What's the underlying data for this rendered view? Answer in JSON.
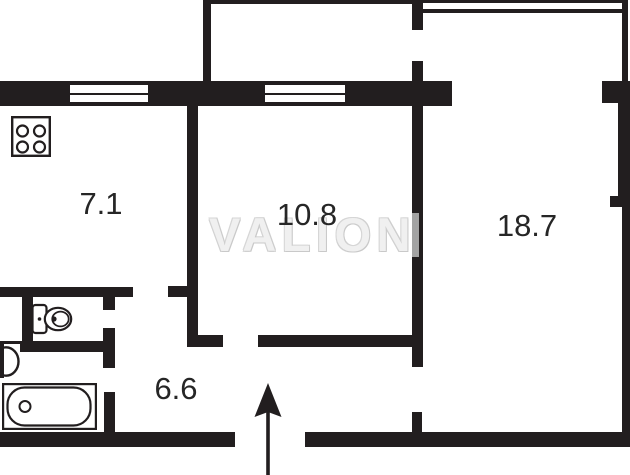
{
  "plan": {
    "watermark_text": "VALION",
    "rooms": [
      {
        "key": "kitchen",
        "area": "7.1"
      },
      {
        "key": "room-mid",
        "area": "10.8"
      },
      {
        "key": "room-big",
        "area": "18.7"
      },
      {
        "key": "hallway",
        "area": "6.6"
      }
    ],
    "fixtures": [
      "stove-icon",
      "toilet-icon",
      "washbasin-icon",
      "bathtub-icon"
    ],
    "entrance": {
      "symbol": "arrow-up"
    },
    "colors": {
      "wall": "#221e1f",
      "background": "#ffffff",
      "label": "#262626",
      "watermark": "#f0f0f0",
      "watermark_outline": "#c9c9c9",
      "doorway_opening": "#a3a3a3"
    }
  }
}
